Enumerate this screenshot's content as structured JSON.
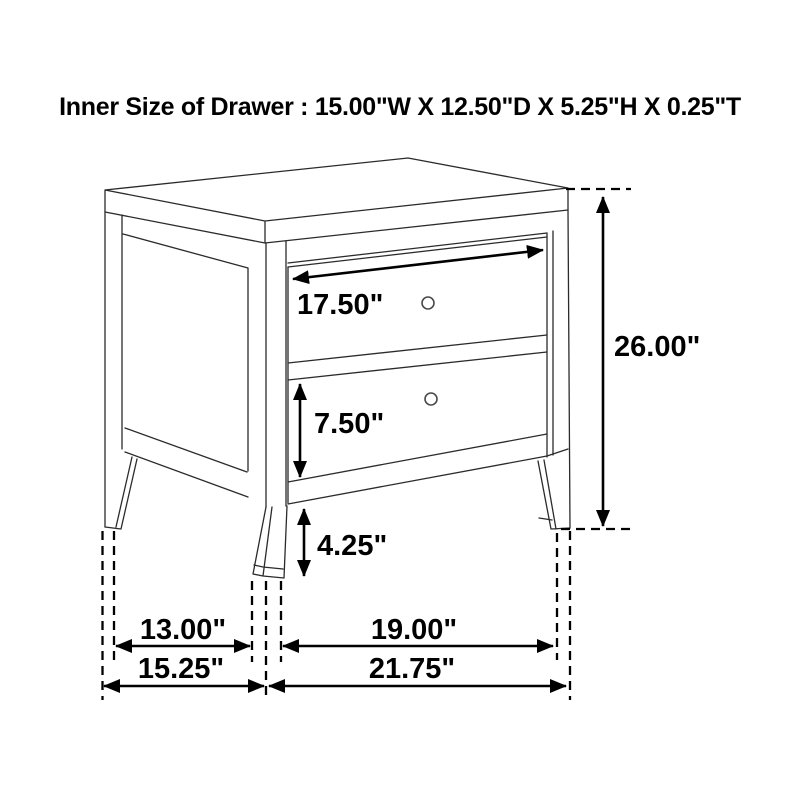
{
  "title": "Inner Size of Drawer : 15.00\"W X 12.50\"D X 5.25\"H X 0.25\"T",
  "diagram": {
    "type": "furniture-dimension-line-drawing",
    "item": "two-drawer nightstand",
    "labels": {
      "drawer_front_width": "17.50\"",
      "bottom_drawer_height": "7.50\"",
      "floor_clearance": "4.25\"",
      "overall_height": "26.00\"",
      "side_leg_spacing": "13.00\"",
      "front_leg_spacing": "19.00\"",
      "overall_depth": "15.25\"",
      "overall_width": "21.75\""
    },
    "colors": {
      "line": "#2b2b2b",
      "dimension": "#000000",
      "background": "#ffffff"
    }
  }
}
